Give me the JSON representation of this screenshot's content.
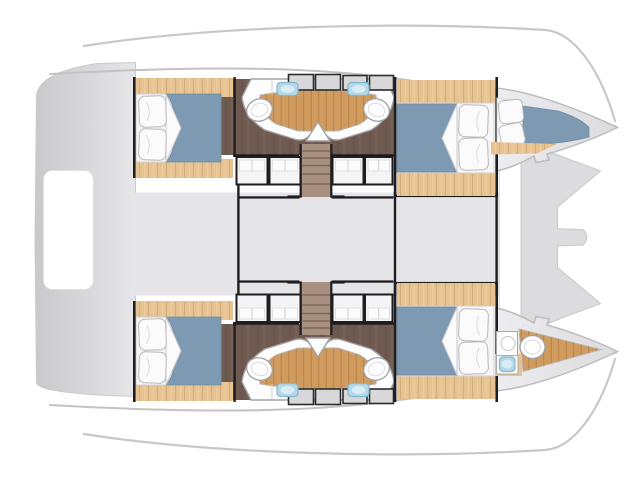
{
  "canvas": {
    "width": 640,
    "height": 480
  },
  "palette": {
    "wood": "#e7c292",
    "teak": "#d19b60",
    "floor": "#6e5a50",
    "stair": "#a7907f",
    "stair_line": "#7f665a",
    "bed_blue": "#7d9ab2",
    "bed_blue_dark": "#6d8aa3",
    "linen": "#fbfbfc",
    "band_gray": "#e5e5e7",
    "stern_gray": "#cdcdcf",
    "hull_light": "#e9e9eb",
    "foredeck_gray": "#dcdcde",
    "wall_black": "#1e1e20",
    "cabinet": "#f4f4f5",
    "locker": "#d8d8da",
    "sink_blue": "#b4d8e7",
    "fixture_white": "#fefefe",
    "fixture_stroke": "#9fa0a3",
    "soft_line": "#c8c8ca"
  },
  "plan": {
    "view": "overhead-deck-plan",
    "vessel_type": "catamaran",
    "hulls": [
      {
        "id": "port-hull-top",
        "rooms": [
          "aft-double-cabin",
          "twin-heads-with-shower",
          "companionway-stairs",
          "forward-double-cabin",
          "forepeak-berth"
        ]
      },
      {
        "id": "starboard-hull-bottom",
        "rooms": [
          "aft-double-cabin",
          "twin-heads-with-shower",
          "companionway-stairs",
          "forward-double-cabin",
          "forepeak-head"
        ]
      }
    ],
    "shared_areas": [
      "stern-platform",
      "cockpit-bridgedeck",
      "foredeck-with-bowsprit",
      "trampolines"
    ],
    "fixture_counts": {
      "double-beds": 4,
      "forepeak-berths": 1,
      "toilets": 5,
      "washbasins": 5,
      "teak-shower-floors": 3,
      "storage-cabinets": 8,
      "stairs": 2
    }
  }
}
